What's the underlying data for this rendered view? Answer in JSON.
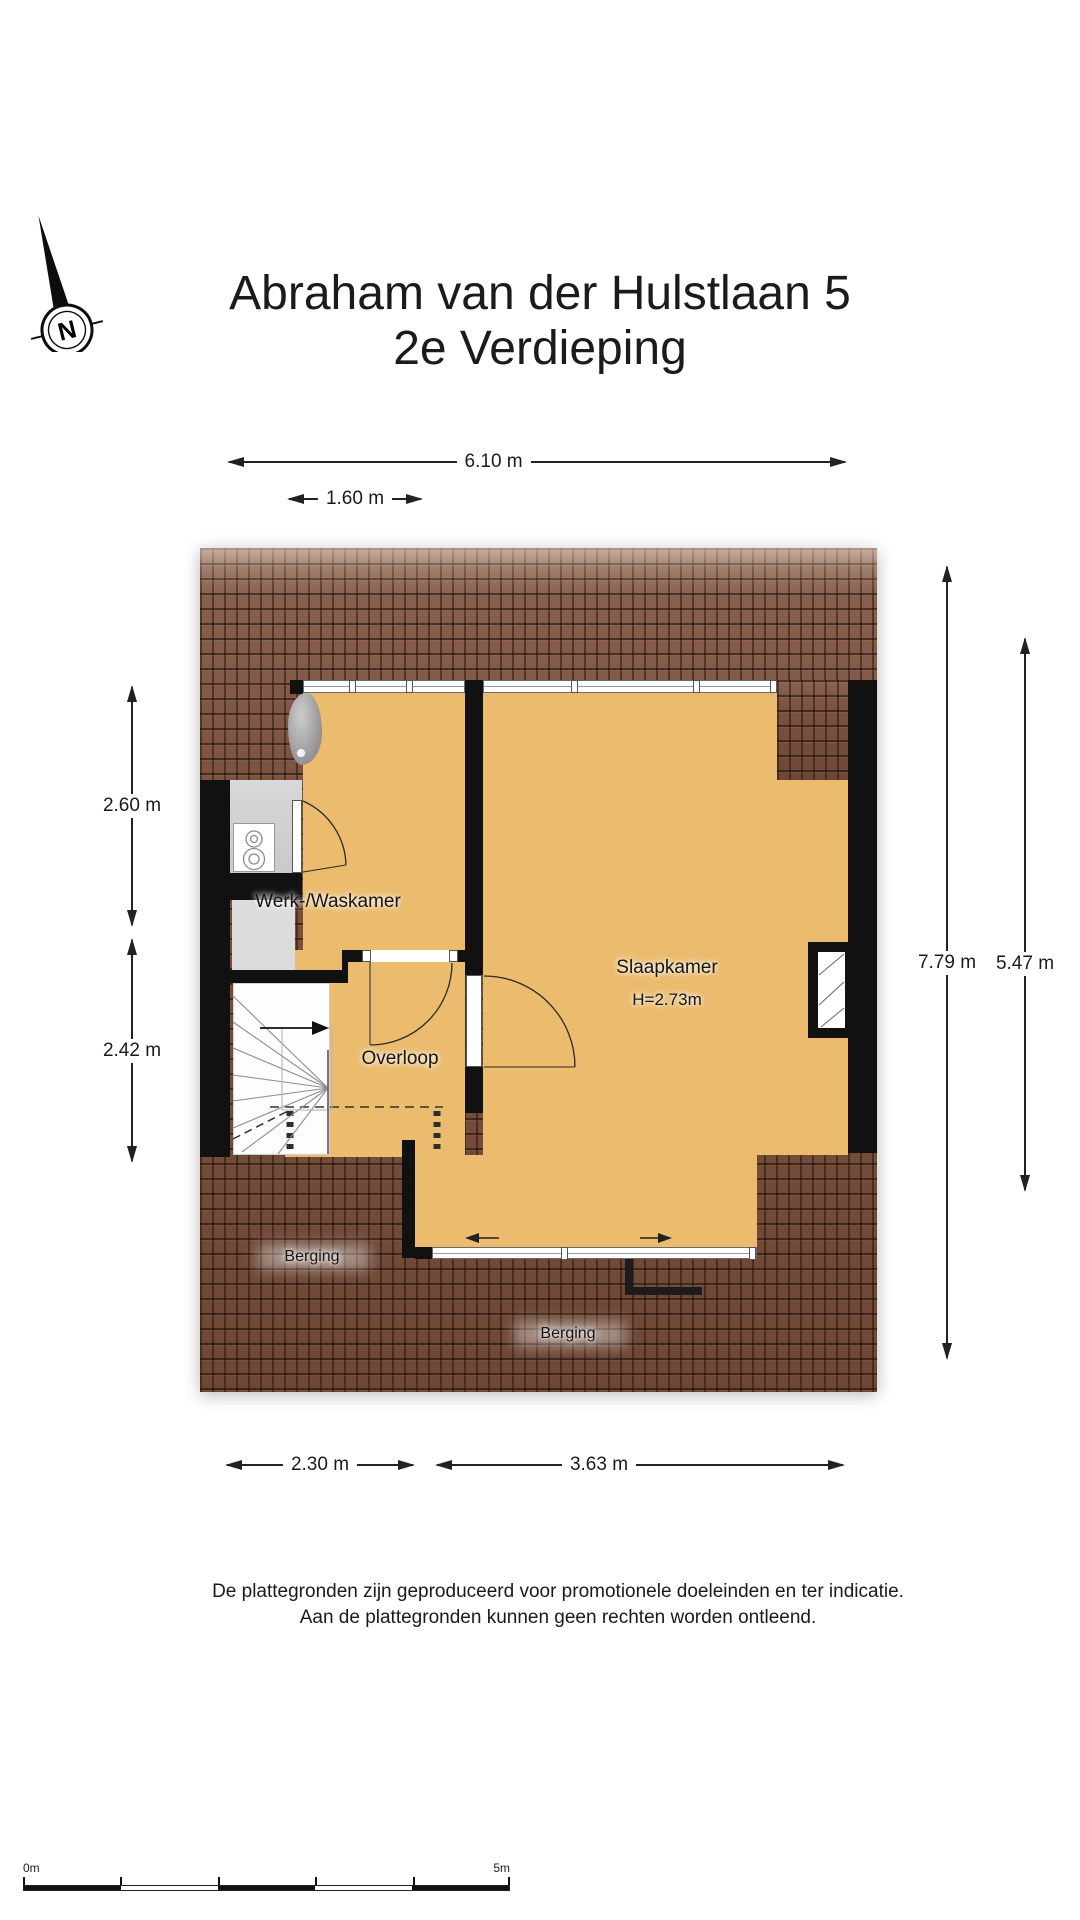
{
  "compass": {
    "label": "N"
  },
  "title": {
    "line1": "Abraham van der Hulstlaan 5",
    "line2": "2e Verdieping"
  },
  "dimensions": {
    "top_width": "6.10 m",
    "top_dormer": "1.60 m",
    "left_upper": "2.60 m",
    "left_lower": "2.42 m",
    "right_full": "7.79 m",
    "right_inner": "5.47 m",
    "bottom_left": "2.30 m",
    "bottom_right": "3.63 m"
  },
  "rooms": {
    "werk": "Werk-/Waskamer",
    "slaap": "Slaapkamer",
    "slaap_height": "H=2.73m",
    "overloop": "Overloop",
    "berging_left": "Berging",
    "berging_right": "Berging"
  },
  "footer": {
    "line1": "De plattegronden zijn geproduceerd voor promotionele doeleinden en ter indicatie.",
    "line2": "Aan de plattegronden kunnen geen rechten worden ontleend."
  },
  "scalebar": {
    "start": "0m",
    "end": "5m"
  },
  "colors": {
    "floor": "#ebbb6e",
    "roofbase": "#7b523f",
    "wall": "#111111",
    "closetgray": "#d2d2d2",
    "stairswhite": "#fdfdfd"
  }
}
